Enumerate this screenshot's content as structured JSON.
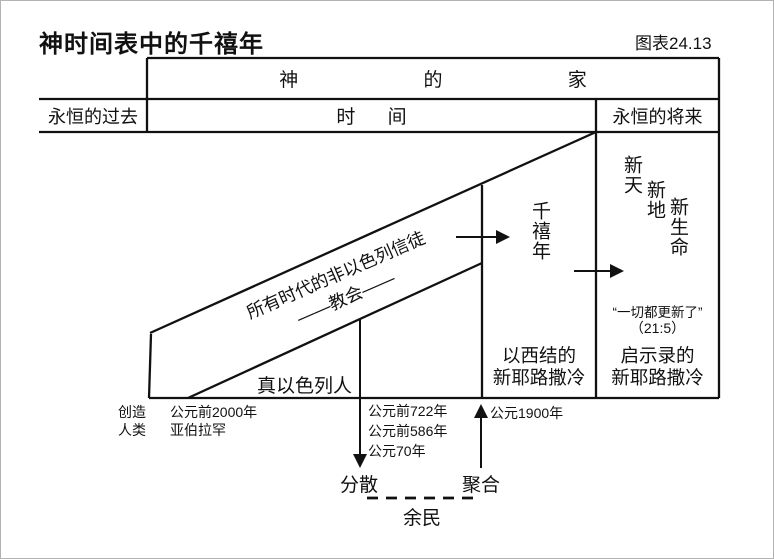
{
  "title": "神时间表中的千禧年",
  "figure_label": "图表24.13",
  "header": {
    "gods_house": "神 的 家",
    "eternal_past": "永恒的过去",
    "time": "时 间",
    "eternal_future": "永恒的将来"
  },
  "band": {
    "line1": "所有时代的非以色列信徒",
    "line2": "——教会——",
    "true_israel": "真以色列人"
  },
  "millennium": "千禧年",
  "new_creation": {
    "new_heaven": "新天",
    "new_earth": "新地",
    "new_life": "新生命",
    "quote": "“一切都更新了”",
    "quote_ref": "（21:5）"
  },
  "jerusalem": {
    "ezekiel_line1": "以西结的",
    "ezekiel_line2": "新耶路撒冷",
    "revelation_line1": "启示录的",
    "revelation_line2": "新耶路撒冷"
  },
  "timeline": {
    "creation_line1": "创造",
    "creation_line2": "人类",
    "abraham_year": "公元前2000年",
    "abraham_name": "亚伯拉罕",
    "year_722": "公元前722年",
    "year_586": "公元前586年",
    "year_70": "公元70年",
    "year_1900": "公元1900年",
    "scatter": "分散",
    "gather": "聚合",
    "remnant": "余民"
  },
  "colors": {
    "ink": "#111111",
    "background": "#ffffff"
  }
}
